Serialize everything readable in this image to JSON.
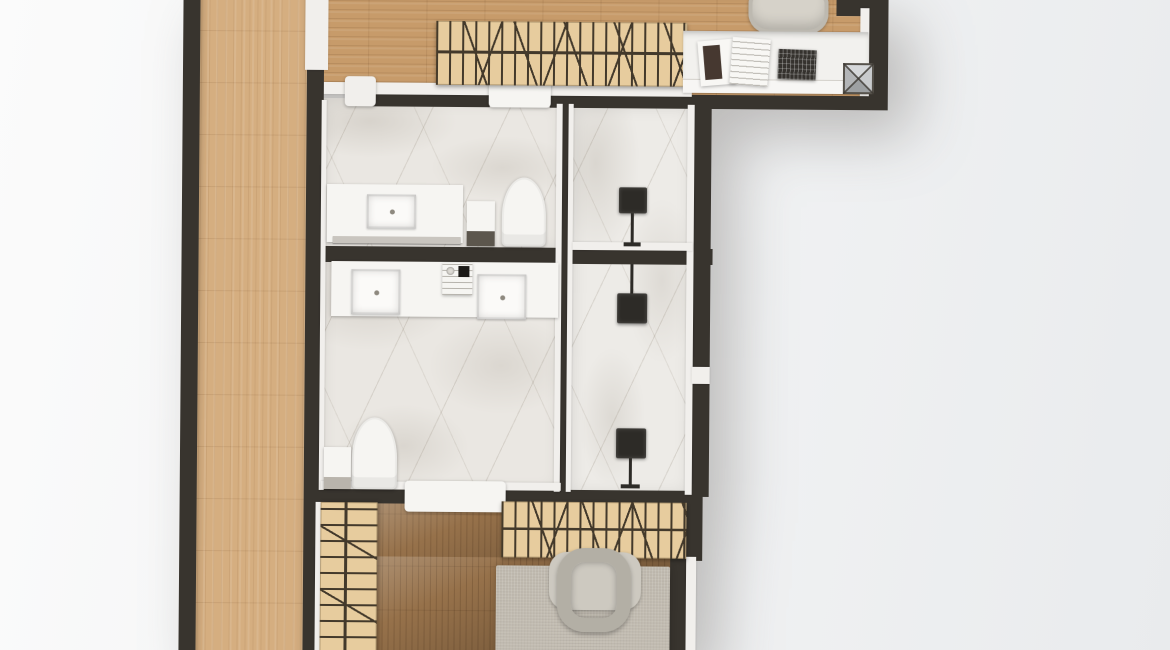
{
  "scene": {
    "title": "apartment-floor-plan-model-top-view",
    "description": "Photorealistic top-down render of an architectural model: wooden entry corridor, slatted stair screens, two marble bathrooms, lamp room, study nook with desk, and living area with rug and lounge chair",
    "visible_text": []
  },
  "palette": {
    "bg_left": "#fbfbfb",
    "bg_right": "#e9ebed",
    "wall_dark": "#38342e",
    "wall_white": "#f1efec",
    "wood_corridor": "#d5ae80",
    "wood_hall": "#c79b6a",
    "wood_floor_dark": "#96714a",
    "wood_screen": "#e7cc9e",
    "slat_dark": "#43392b",
    "marble_light": "#eae7e2",
    "fixture_white": "#f6f5f2",
    "counter_grey": "#c9c5bf",
    "rug_grey": "#c2bcb1",
    "chair_grey": "#b3afa5",
    "lamp_dark": "#2d2b27",
    "desk_white": "#f2f1ee",
    "keyboard_dark": "#35322e"
  },
  "rooms": [
    {
      "id": "entry-corridor",
      "floor": "light wood planks"
    },
    {
      "id": "upper-hallway",
      "floor": "wood planks"
    },
    {
      "id": "study-nook",
      "furniture": [
        "desk",
        "desk chair",
        "magazine",
        "notebook",
        "keyboard tray",
        "pyramid skylight"
      ]
    },
    {
      "id": "bathroom-top",
      "furniture": [
        "vanity with sink",
        "storage cabinet",
        "toilet"
      ]
    },
    {
      "id": "bathroom-middle",
      "furniture": [
        "double vanity",
        "control unit",
        "toilet",
        "storage box"
      ]
    },
    {
      "id": "lamp-room-upper",
      "furniture": [
        "floor lamp"
      ]
    },
    {
      "id": "lamp-room-lower",
      "furniture": [
        "floor lamp",
        "floor lamp"
      ]
    },
    {
      "id": "living-area-bottom",
      "furniture": [
        "area rug",
        "lounge chair",
        "slatted screen"
      ]
    },
    {
      "id": "staircase-left",
      "furniture": [
        "slatted stair screen"
      ]
    },
    {
      "id": "staircase-top",
      "furniture": [
        "slatted stair screen"
      ]
    }
  ]
}
